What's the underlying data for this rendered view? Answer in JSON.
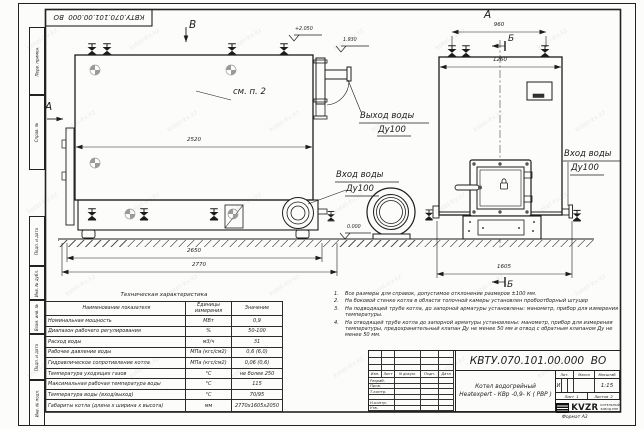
{
  "meta": {
    "format_label": "Формат  А3",
    "watermark": "kotel-kv.kz"
  },
  "margin_boxes": [
    "Перв. примен.",
    "Справ. №",
    "Подп. и дата",
    "Инв. № дубл.",
    "Взам. инв. №",
    "Подп. и дата",
    "Инв. № подл."
  ],
  "views": {
    "view_b_label": "В",
    "view_a_side_label": "А",
    "view_a_label": "А",
    "section_b_top": "Б",
    "section_b_bottom": "Б",
    "see_note": "см. п. 2"
  },
  "dimensions": {
    "d2520": "2520",
    "d2650": "2650",
    "d2770": "2770",
    "d960": "960",
    "d1260": "1260",
    "d1605": "1605",
    "elev_top": "+2.050",
    "elev_mid": "1.930",
    "elev_zero": "0.000"
  },
  "labels": {
    "outlet_line1": "Выход воды",
    "outlet_line2": "Ду100",
    "inlet_left_line1": "Вход воды",
    "inlet_left_line2": "Ду100",
    "inlet_right_line1": "Вход воды",
    "inlet_right_line2": "Ду100"
  },
  "notes": [
    {
      "num": "1.",
      "text": "Все размеры для справок, допустимое отклонение размеров ±100 мм."
    },
    {
      "num": "2.",
      "text": "На боковой стенке котла в области топочной камеры установлен пробоотборный штуцер"
    },
    {
      "num": "3.",
      "text": "На  подводящей трубе котла, до запорной арматуры установлены: манометр, прибор для измерения температуры."
    },
    {
      "num": "4.",
      "text": "На отводящей трубе котла до запорной арматуры установлены: манометр, прибор для измерения температуры, предохранительный клапан Ду не менее 50 мм и отвод с обратным клапаном Ду не менее 50 мм."
    }
  ],
  "spec_table": {
    "title": "Техническая характеристика",
    "headers": [
      "Наименование показателя",
      "Единицы измерения",
      "Значение"
    ],
    "rows": [
      [
        "Номинальная мощность",
        "МВт",
        "0,9"
      ],
      [
        "Диапазон рабочего регулирования",
        "%",
        "50-100"
      ],
      [
        "Расход воды",
        "м3/ч",
        "31"
      ],
      [
        "Рабочее давление воды",
        "МПа (кгс/см2)",
        "0,6 (6,0)"
      ],
      [
        "Гидравлическое сопротивление котла",
        "МПа (кгс/см2)",
        "0,06 (0,6)"
      ],
      [
        "Температура уходящих газов",
        "°С",
        "не более 250"
      ],
      [
        "Максимальная рабочая температура воды",
        "°С",
        "115"
      ],
      [
        "Температура воды (вход/выход)",
        "°С",
        "70/95"
      ],
      [
        "Габариты котла (длина х ширина х высота)",
        "мм",
        "2770х1605х2050"
      ]
    ]
  },
  "title_block": {
    "doc_number": "КВТУ.070.101.00.000  ВО",
    "product_name_line1": "Котел водогрейный",
    "product_name_line2": "Heatexpert - КВр -0,9- К ( РВР )",
    "rev_header": [
      "Изм.",
      "Лист",
      "N докум.",
      "Подп.",
      "Дата"
    ],
    "roles": [
      "Разраб.",
      "Пров.",
      "Т.контр.",
      "",
      "Н.контр.",
      "Утв."
    ],
    "lit_label": "Лит.",
    "mass_label": "Масса",
    "scale_label": "Масштаб",
    "lit_value": "И",
    "scale_value": "1:15",
    "sheet_label": "Лист",
    "sheet_value": "1",
    "sheets_label": "Листов",
    "sheets_value": "2",
    "logo_text": "KVZR",
    "company_line1": "КОТЕЛЬНЫЙ",
    "company_line2": "ЗАВОД РЭП"
  }
}
